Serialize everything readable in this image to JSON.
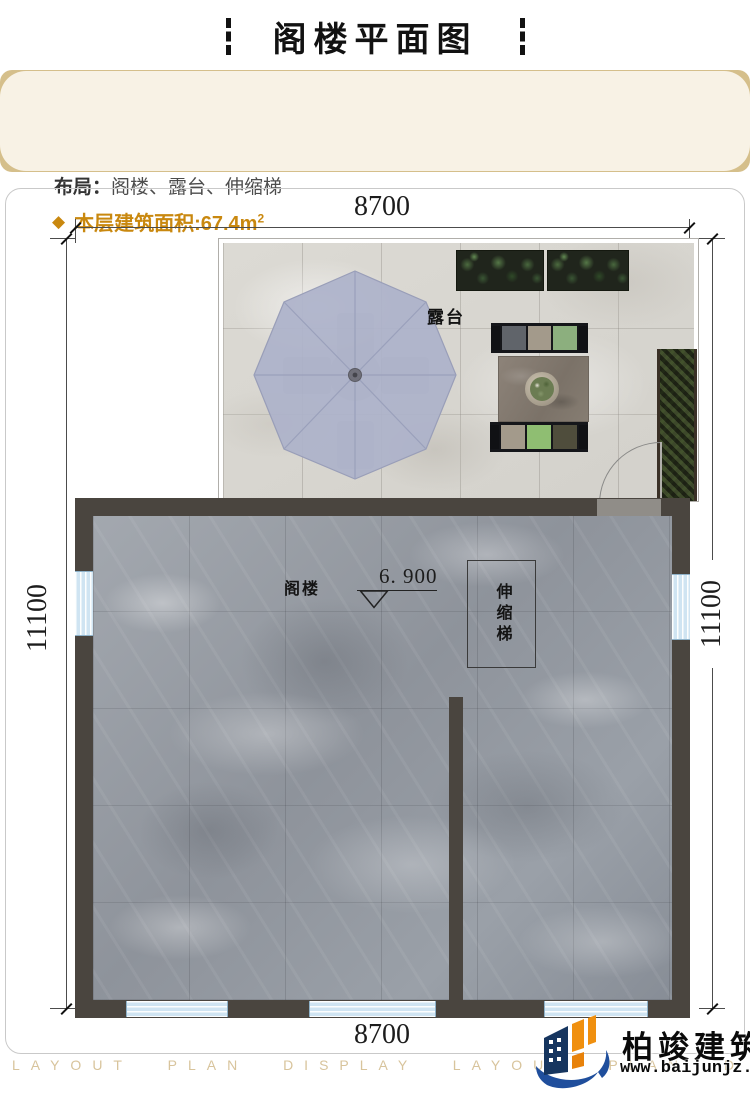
{
  "header": {
    "title": "阁楼平面图"
  },
  "info": {
    "layout_label": "布局：",
    "layout_value": "阁楼、露台、伸缩梯",
    "bullet": "◆",
    "area_label": "本层建筑面积:",
    "area_value": "67.4m",
    "area_sup": "2"
  },
  "plan": {
    "dim_top": "8700",
    "dim_bottom": "8700",
    "dim_left": "11100",
    "dim_right": "11100",
    "terrace_label": "露台",
    "attic_label": "阁楼",
    "level_value": "6. 900",
    "ladder_label": "伸缩梯"
  },
  "footer": {
    "watermark": "LAYOUT PLAN DISPLAY LAYOUT PLAN DISPLAY",
    "logo_name": "柏竣建筑",
    "logo_url": "www.baijunjz.com"
  },
  "colors": {
    "accent_gold": "#c9880f",
    "card_cream": "#f8f2e5",
    "card_tan": "#d5bf8b",
    "wall_dark": "#4a453f",
    "window_blue": "#cfe4f2",
    "umbrella_lavender": "#adb2ca",
    "marble_gray": "#979ca3",
    "terrace_stone": "#d8d6d0",
    "watermark_tan": "#d8c49c",
    "logo_blue": "#1f4e9c",
    "logo_navy": "#16355f",
    "logo_orange": "#f0900f"
  }
}
